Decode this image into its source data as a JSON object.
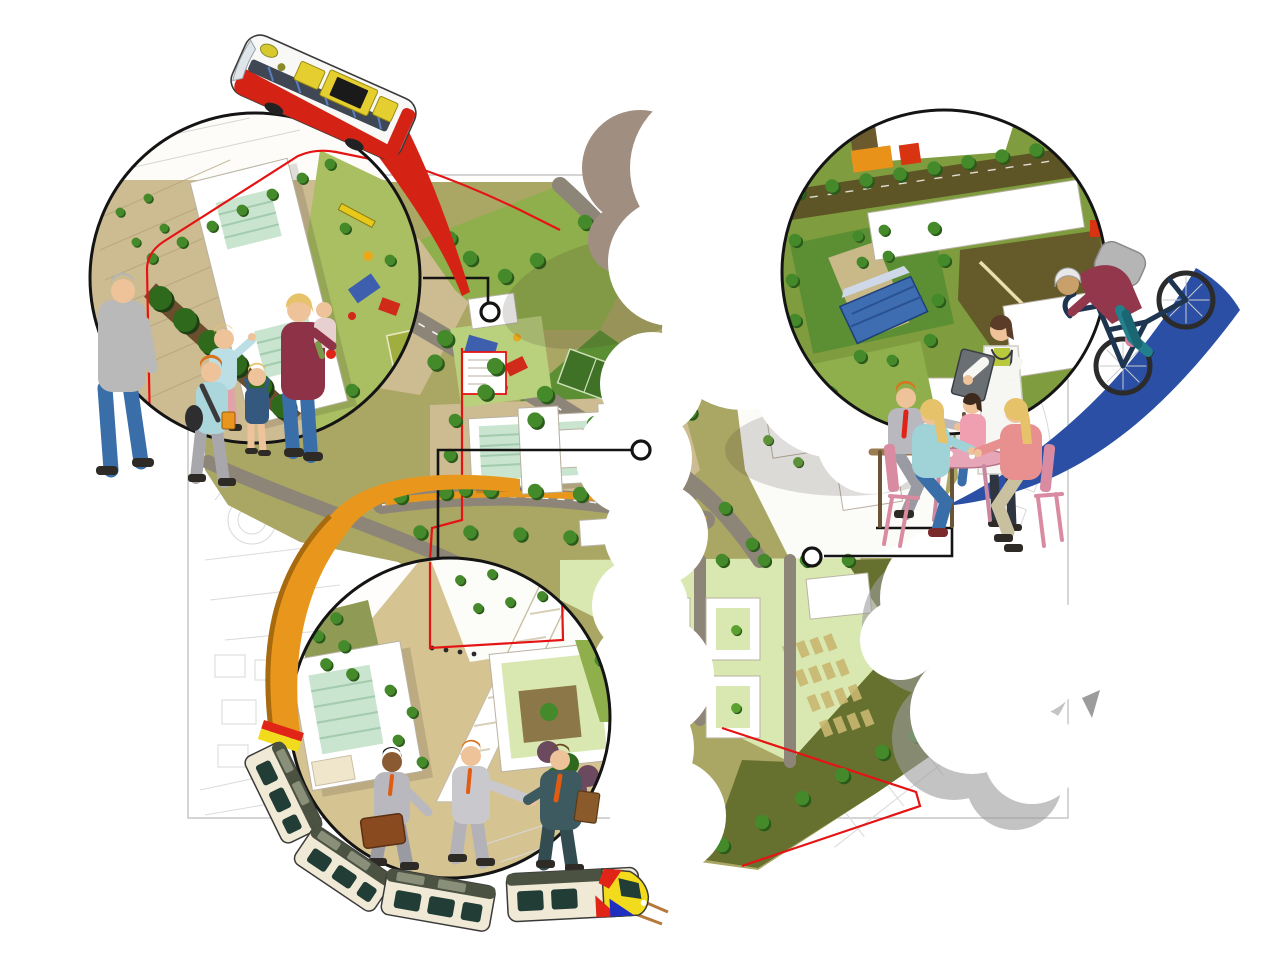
{
  "palette": {
    "map_line": "#d8d8d8",
    "map_line_dark": "#c4c4c4",
    "map_rect": "#bdbdbd",
    "plan_tan": "#cdbc92",
    "plan_tan_light": "#d9cda6",
    "plaza_tan": "#d6c392",
    "plan_olive": "#aaa664",
    "plan_green": "#8fae4c",
    "campus_green": "#7f9c3f",
    "plan_green_dark": "#5c8f33",
    "plan_green_deep": "#3f7226",
    "plan_lime": "#d9e8b0",
    "playground_green": "#b9d07c",
    "plan_brown_dark": "#5e5526",
    "plan_brown": "#8c7748",
    "street": "#8d8577",
    "building_white": "#ffffff",
    "building_stroke": "#b9b2a2",
    "roof_mint": "#c9e4cf",
    "roof_mint_stripe": "#a3cbad",
    "solar_blue": "#3e6db2",
    "tree_green": "#44892a",
    "tree_green_light": "#5ba132",
    "tree_dark": "#2a5a1a",
    "hedge_dark": "#2f6a1c",
    "bush_purple": "#6b4a5f",
    "boundary_red": "#e51414",
    "leader_black": "#141414",
    "ribbon_red": "#d42315",
    "ribbon_orange": "#e8971c",
    "ribbon_orange_dark": "#a86a0e",
    "ribbon_blue": "#2a4fa5",
    "cloud_taupe": "#a08e80",
    "cloud_grey": "#9c9c9c",
    "shadow_soft": "rgba(60,50,40,0.16)",
    "bus_body": "#f8f8f6",
    "bus_red": "#d42315",
    "bus_window": "#2e3744",
    "bus_yellow": "#e5ce2f",
    "tram_cream": "#efe9d6",
    "tram_roof": "#4c5242",
    "tram_roof_panel": "#8a8f7a",
    "tram_window": "#223c36",
    "tram_yellow": "#f2da1c",
    "tram_red": "#e02418",
    "tram_blue": "#1f2fbf",
    "rail_tan": "#b5793c",
    "bike_frame": "#1e3552",
    "wheel_dark": "#2b2b2b",
    "skin": "#eec39a",
    "skin_dark": "#8a5a33",
    "hair_grey": "#b5b5b5",
    "hair_blonde": "#e6c26a",
    "hair_brown": "#6e4a26",
    "hair_orange": "#d8731e",
    "suit_grey": "#b8b8be",
    "suit_grey_dark": "#9a9aa2",
    "suit_teal": "#3c5a60",
    "suit_teal_dark": "#324c52",
    "tie_orange": "#e05c12",
    "tie_red": "#e02418",
    "sweater_grey": "#b9b9b9",
    "sweater_maroon": "#8e3347",
    "jacket_maroon": "#93374d",
    "shirt_lightblue": "#bcdfe6",
    "pants_pink": "#e0a3a8",
    "jeans_blue": "#3a6ea8",
    "pants_grey": "#a8a8ac",
    "pants_teal": "#22808c",
    "pants_khaki": "#c9c0a0",
    "top_pink": "#ef9fb0",
    "top_salmon": "#e88f8f",
    "coat_white": "#f6f6f2",
    "table_pink": "#e7a6b8",
    "chair_pink": "#d98ba2",
    "case_brown": "#8a4a1f",
    "folder_brown": "#8a5a2a",
    "shoe_dark": "#2e2a26",
    "bench_brown": "#9a7b52"
  },
  "scene": {
    "type": "urban-masterplan-vision-illustration",
    "callouts": [
      {
        "id": "callout-playground-families",
        "position": "top-left"
      },
      {
        "id": "callout-health-campus",
        "position": "top-right"
      },
      {
        "id": "callout-business-quarter",
        "position": "bottom-center"
      }
    ],
    "vehicles": [
      {
        "id": "bus",
        "ribbon": "ribbon_red"
      },
      {
        "id": "tram",
        "ribbon": "ribbon_orange"
      },
      {
        "id": "bicycle",
        "ribbon": "ribbon_blue"
      }
    ],
    "figure_groups": [
      "walking-family",
      "doctor-with-residents",
      "seated-residents",
      "business-people",
      "cyclist"
    ],
    "leader_markers": 3
  }
}
